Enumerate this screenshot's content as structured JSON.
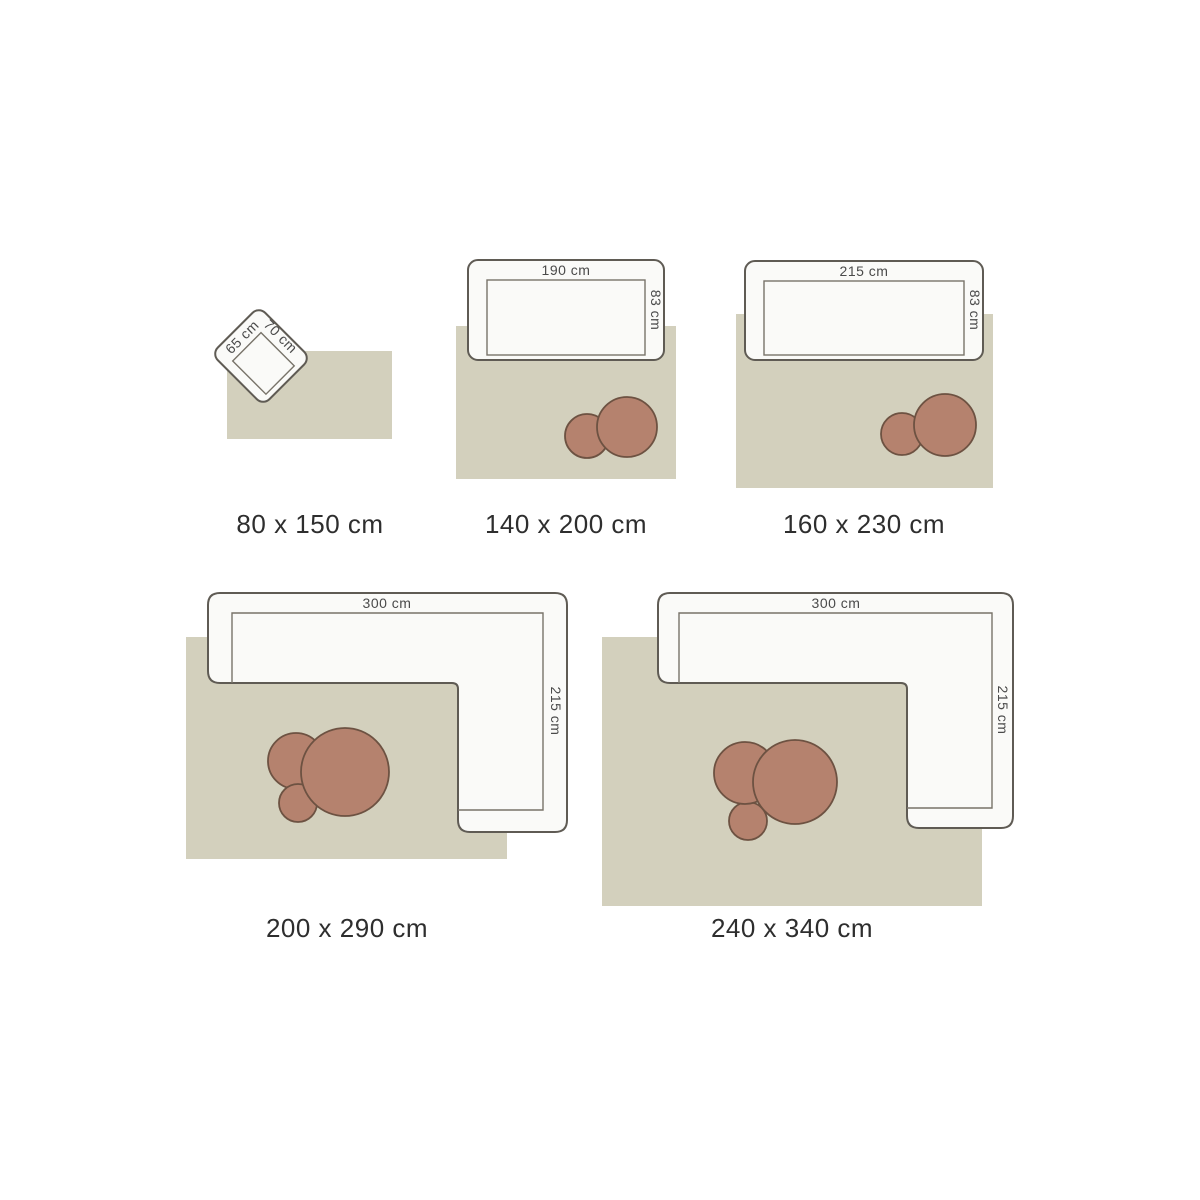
{
  "colors": {
    "background": "#ffffff",
    "rug": "#d3d0bd",
    "furniture-fill": "#fafaf8",
    "furniture-stroke": "#5f5b54",
    "inner-stroke": "#787369",
    "table-fill": "#b5826e",
    "table-stroke": "#6d5242",
    "dim-text": "#4a4a4a",
    "size-text": "#2e2e2e"
  },
  "diagram": {
    "description": "rug-size-guide",
    "unit": "cm"
  },
  "items": [
    {
      "size_label": "80 x 150 cm",
      "furniture": "armchair",
      "dim_top": "65 cm",
      "dim_side": "70 cm",
      "tables_count": 0
    },
    {
      "size_label": "140 x 200 cm",
      "furniture": "sofa",
      "dim_top": "190 cm",
      "dim_side": "83 cm",
      "tables_count": 2
    },
    {
      "size_label": "160 x 230 cm",
      "furniture": "sofa",
      "dim_top": "215 cm",
      "dim_side": "83 cm",
      "tables_count": 2
    },
    {
      "size_label": "200 x 290 cm",
      "furniture": "corner-sofa",
      "dim_top": "300 cm",
      "dim_side": "215 cm",
      "tables_count": 3
    },
    {
      "size_label": "240 x 340 cm",
      "furniture": "corner-sofa",
      "dim_top": "300 cm",
      "dim_side": "215 cm",
      "tables_count": 3
    }
  ]
}
